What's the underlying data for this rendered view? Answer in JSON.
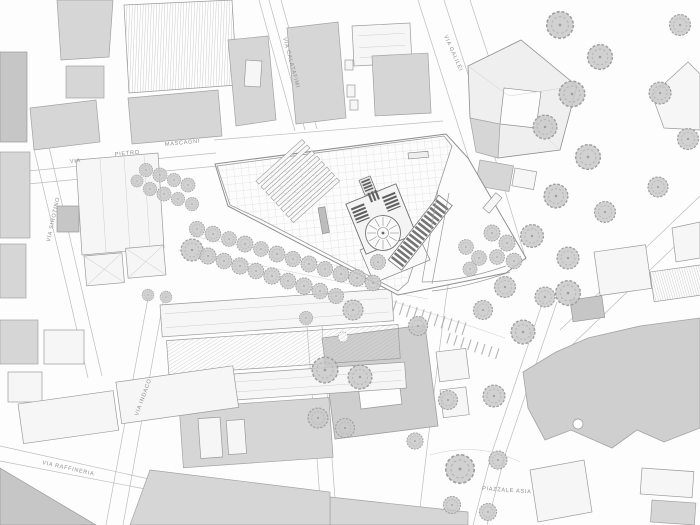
{
  "street_labels": {
    "via": "VIA",
    "pietro": "PIETRO",
    "mascagni": "MASCAGNI",
    "calatafimi": "VIA CALATAFIMI",
    "galilei": "VIA GALILEI",
    "sirotino": "VIA SIROTINO",
    "indaco": "VIA INDACO",
    "raffineria": "VIA RAFFINERIA",
    "piazzale_asia": "PIAZZALE ASIA"
  },
  "colors": {
    "background": "#fdfdfd",
    "building_gray": "#d6d6d6",
    "building_dark": "#c6c6c6",
    "building_white": "#f6f6f6",
    "outline": "#9b9b9b",
    "street_line": "#bdbdbd",
    "tree_fill": "#c9c9c9",
    "label_text": "#8f8f8f",
    "hatch_dark": "#5f5f5f"
  },
  "trees": [
    [
      197,
      229,
      0.8
    ],
    [
      213,
      234,
      0.82
    ],
    [
      229,
      239,
      0.78
    ],
    [
      245,
      244,
      0.84
    ],
    [
      261,
      249,
      0.78
    ],
    [
      277,
      254,
      0.84
    ],
    [
      293,
      259,
      0.8
    ],
    [
      309,
      264,
      0.84
    ],
    [
      325,
      269,
      0.8
    ],
    [
      341,
      274,
      0.84
    ],
    [
      357,
      278,
      0.88
    ],
    [
      373,
      283,
      0.82
    ],
    [
      192,
      250,
      1.15
    ],
    [
      208,
      256,
      0.85
    ],
    [
      224,
      261,
      0.82
    ],
    [
      240,
      266,
      0.86
    ],
    [
      256,
      271,
      0.82
    ],
    [
      272,
      276,
      0.86
    ],
    [
      288,
      281,
      0.82
    ],
    [
      304,
      286,
      0.86
    ],
    [
      320,
      291,
      0.82
    ],
    [
      336,
      296,
      0.8
    ],
    [
      146,
      170,
      0.7
    ],
    [
      160,
      175,
      0.74
    ],
    [
      174,
      180,
      0.7
    ],
    [
      188,
      185,
      0.74
    ],
    [
      150,
      189,
      0.7
    ],
    [
      164,
      194,
      0.74
    ],
    [
      178,
      199,
      0.7
    ],
    [
      192,
      204,
      0.7
    ],
    [
      137,
      181,
      0.64
    ],
    [
      466,
      247,
      0.78
    ],
    [
      479,
      258,
      0.78
    ],
    [
      470,
      269,
      0.74
    ],
    [
      492,
      233,
      0.84
    ],
    [
      507,
      243,
      0.84
    ],
    [
      497,
      257,
      0.78
    ],
    [
      514,
      261,
      0.82
    ],
    [
      378,
      262,
      0.8
    ],
    [
      560,
      25,
      1.4
    ],
    [
      600,
      57,
      1.3
    ],
    [
      572,
      94,
      1.35
    ],
    [
      545,
      127,
      1.25
    ],
    [
      588,
      157,
      1.3
    ],
    [
      556,
      196,
      1.25
    ],
    [
      605,
      212,
      1.1
    ],
    [
      532,
      236,
      1.2
    ],
    [
      568,
      258,
      1.15
    ],
    [
      505,
      287,
      1.1
    ],
    [
      545,
      297,
      1.05
    ],
    [
      483,
      310,
      1.0
    ],
    [
      660,
      93,
      1.15
    ],
    [
      688,
      139,
      1.1
    ],
    [
      658,
      187,
      1.05
    ],
    [
      680,
      25,
      1.1
    ],
    [
      460,
      469,
      1.5
    ],
    [
      498,
      460,
      0.95
    ],
    [
      523,
      332,
      1.25
    ],
    [
      494,
      396,
      1.15
    ],
    [
      452,
      505,
      0.9
    ],
    [
      488,
      512,
      0.9
    ],
    [
      568,
      293,
      1.3
    ],
    [
      353,
      310,
      1.05
    ],
    [
      418,
      326,
      1.0
    ],
    [
      325,
      370,
      1.35
    ],
    [
      360,
      377,
      1.25
    ],
    [
      318,
      418,
      1.05
    ],
    [
      345,
      428,
      1.0
    ],
    [
      448,
      400,
      1.0
    ],
    [
      415,
      441,
      0.85
    ],
    [
      306,
      318,
      0.7
    ],
    [
      148,
      295,
      0.62
    ],
    [
      166,
      297,
      0.62
    ]
  ]
}
